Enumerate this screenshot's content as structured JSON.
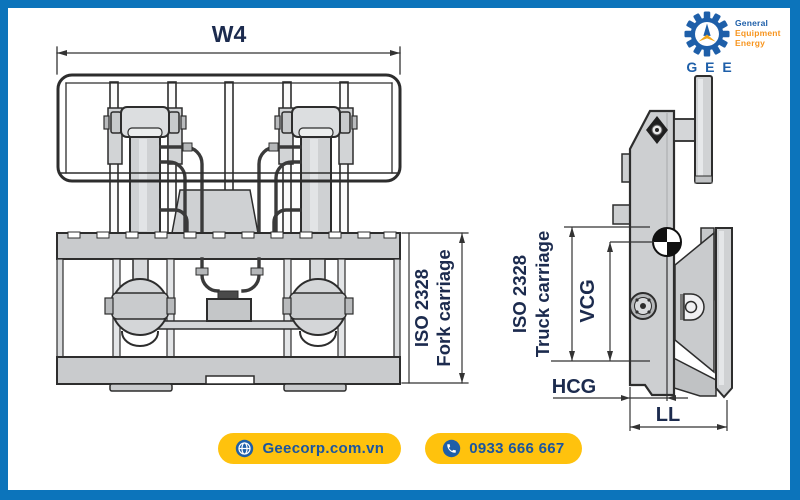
{
  "brand": {
    "name_line1": "General",
    "name_line2": "Equipment",
    "name_line3": "Energy",
    "abbrev": "G E E"
  },
  "front_view": {
    "width_label": "W4",
    "standard_line1": "ISO 2328",
    "standard_line2": "Fork carriage"
  },
  "side_view": {
    "standard_line1": "ISO 2328",
    "standard_line2": "Truck carriage",
    "vcg_label": "VCG",
    "hcg_label": "HCG",
    "ll_label": "LL"
  },
  "footer": {
    "website": "Geecorp.com.vn",
    "phone": "0933 666 667"
  },
  "colors": {
    "frame_blue": "#0C74BB",
    "accent_yellow": "#FFC20D",
    "brand_blue": "#1E5FA9",
    "brand_orange": "#F7941D",
    "label_navy": "#1C2B4E",
    "button_text_blue": "#1A55A0"
  }
}
